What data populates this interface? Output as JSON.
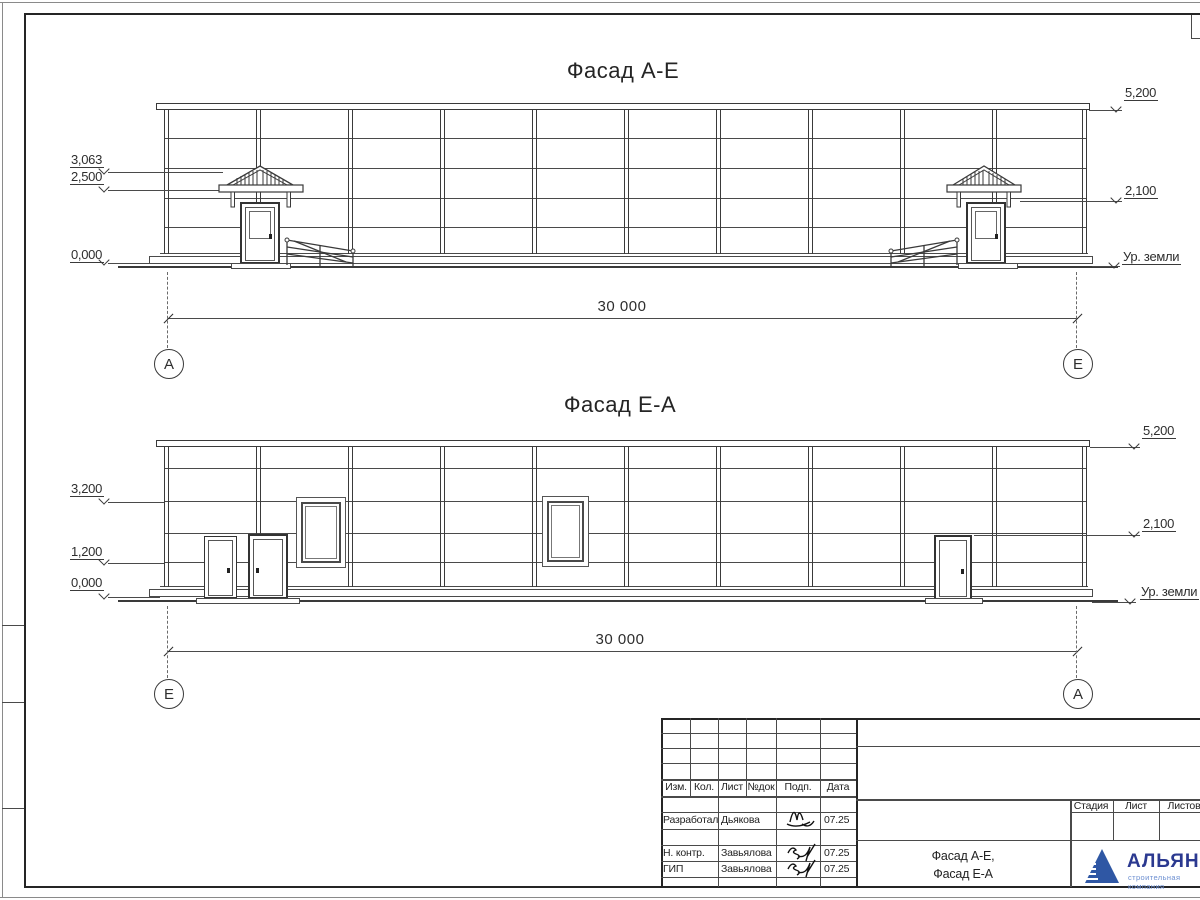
{
  "drawing": {
    "facades": [
      {
        "title": "Фасад А-Е",
        "dimension": "30 000",
        "axis_left": "А",
        "axis_right": "Е",
        "marks_left": [
          "3,063",
          "2,500",
          "0,000"
        ],
        "marks_right": [
          "5,200",
          "2,100",
          "Ур. земли"
        ]
      },
      {
        "title": "Фасад Е-А",
        "dimension": "30 000",
        "axis_left": "Е",
        "axis_right": "А",
        "marks_left": [
          "3,200",
          "1,200",
          "0,000"
        ],
        "marks_right": [
          "5,200",
          "2,100",
          "Ур. земли"
        ]
      }
    ]
  },
  "title_block": {
    "revision_header": {
      "izm": "Изм.",
      "kol": "Кол.",
      "list": "Лист",
      "doc_no": "№док",
      "sign": "Подп.",
      "date": "Дата"
    },
    "staff": [
      {
        "role": "Разработал",
        "name": "Дьякова",
        "date": "07.25"
      },
      {
        "role": "Н. контр.",
        "name": "Завьялова",
        "date": "07.25"
      },
      {
        "role": "ГИП",
        "name": "Завьялова",
        "date": "07.25"
      }
    ],
    "sheet_title": [
      "Фасад А-Е,",
      "Фасад Е-А"
    ],
    "stage_header": [
      "Стадия",
      "Лист",
      "Листов"
    ],
    "company": {
      "name": "АЛЬЯНС",
      "tagline": "строительная компания"
    }
  },
  "colors": {
    "line": "#3a3a3a",
    "logo_triangle": "#2f57a4",
    "logo_name": "#2b3990",
    "logo_tagline": "#6c8fd1"
  }
}
